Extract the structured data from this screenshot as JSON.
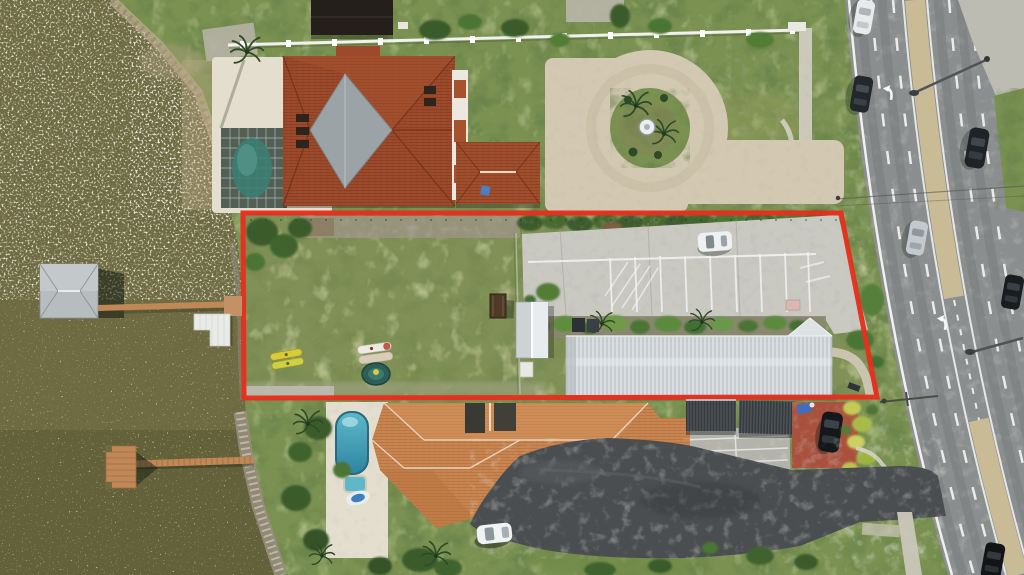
{
  "meta": {
    "type": "aerial-photograph",
    "title": "Aerial drone view of a waterfront lot outlined in red between two tile-roof homes, beside a multi-lane highway",
    "width_px": 1024,
    "height_px": 575,
    "visible_text": []
  },
  "palette": {
    "water": "#6e6a41",
    "water_deep": "#5c5b36",
    "sparkle": "#f4f2ea",
    "grass": "#7a9152",
    "parcel_grass": "#87905a",
    "tree_dark": "#3b5c2c",
    "bush_yellow": "#b9c45c",
    "concrete": "#c9c9c2",
    "paver_drive": "#d3c9b2",
    "gravel": "#9a937f",
    "sidewalk": "#cfccc0",
    "roof_terracotta": "#9c4a2b",
    "roof_diamond_gray": "#9ba3a6",
    "roof_tan": "#c9854f",
    "ridge_white": "#eadbc8",
    "metal_roof": "#ccd1d5",
    "carport_dark": "#363b40",
    "asphalt_drive": "#4b4e50",
    "road_asphalt": "#8b8e8e",
    "lane_white": "#f5f6f4",
    "median_tan": "#c9bb95",
    "boundary_red": "#e5301f",
    "dock_wood": "#c08757",
    "boathouse_roof": "#b7bcbf",
    "pool_teal": "#5fb7c9",
    "pool_deep": "#2e85a3",
    "deck_white": "#e4decf",
    "fence_white": "#f1f2ee",
    "courtyard_pavers": "#a9513d",
    "shadow_green": "#1c2418"
  },
  "scene": {
    "water_body": {
      "position": "left edge, full height",
      "appearance": "olive-brown water with dense white sun-glint ripples",
      "features": [
        "boathouse with gray hip roof",
        "long catwalk dock to shore",
        "white floating jet-dock",
        "t-shaped wooden dock lower left"
      ]
    },
    "highlighted_parcel": {
      "outline_color": "#e5301f",
      "outline_shape": "wide trapezoid, top edge y~213, bottom y~398, left x~243, right edge slanting 841->877",
      "contents": [
        "open mowed grass lot",
        "gravel rubble strip along top",
        "hedge row",
        "two yellow kayaks",
        "two white kayaks",
        "teal round raft",
        "picnic table",
        "small white shed",
        "long white ribbed metal-roof building",
        "concrete parking lot with striped stalls and hatched zone",
        "parked white car",
        "landscaped shrub strip",
        "winding footpath"
      ]
    },
    "north_property": {
      "contents": [
        "large terracotta hip roof house with gray diamond roof section",
        "screened pool enclosure with dark pool",
        "white pool deck",
        "detached terracotta garage",
        "beige circular paver driveway with fountain island and palms",
        "white perimeter fence",
        "dark-roof neighbor structure at top edge"
      ]
    },
    "south_property": {
      "contents": [
        "large tan tile hip roof house",
        "lap pool with spa and pool float on white paver deck",
        "two dark ribbed carports",
        "red paver courtyard with dark parked car",
        "yellow-green shrub row",
        "asphalt driveway looping to highway",
        "white car parked on asphalt",
        "tree clusters along shore and bottom edge"
      ]
    },
    "highway": {
      "position": "right side, slightly skewed clockwise",
      "features": [
        "solid white edge lines",
        "dashed lane lines",
        "tan raised median with left-turn bay",
        "two painted white turn arrows",
        "two streetlight arms",
        "overhead utility wires",
        "six vehicles (mix of dark and silver/white cars)"
      ],
      "vehicle_count": 6
    }
  }
}
